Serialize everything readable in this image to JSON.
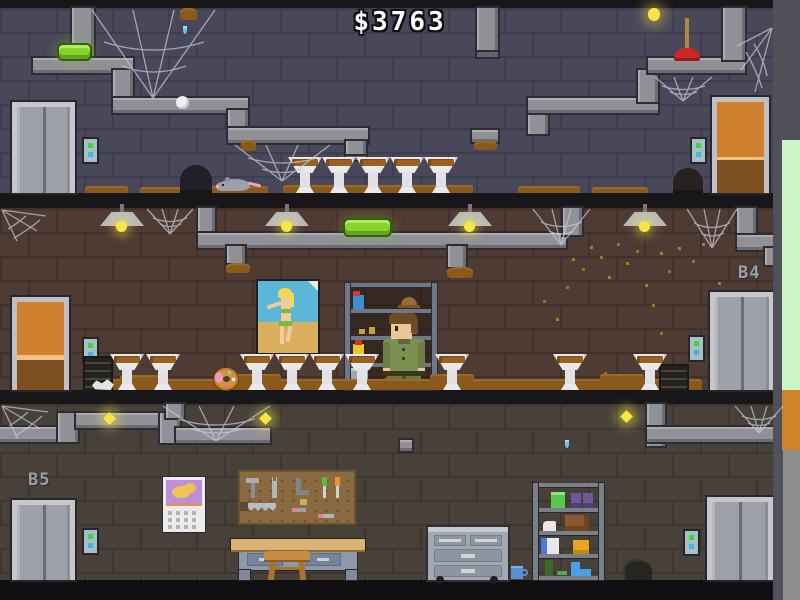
{
  "hud": {
    "money": "$3763"
  },
  "floors": {
    "b3": {
      "label": "",
      "objects": [
        "elevator-door",
        "call-button",
        "wooden-door",
        "dirty-sink x5",
        "rat",
        "mouse-hole",
        "wall-hole",
        "plunger",
        "ceiling-bulb",
        "green-tube-lamp",
        "white-egg",
        "pipes",
        "cobwebs",
        "dirt-patches"
      ]
    },
    "b4": {
      "label": "B4",
      "objects": [
        "wooden-door",
        "elevator-door",
        "call-button x2",
        "hanging-lamp x4",
        "green-tube-lamp",
        "pinup-poster",
        "supply-shelf",
        "spray-bottle",
        "hat",
        "yellow-bottle",
        "detergent-box",
        "bucket",
        "player-character",
        "dirty-sink x9",
        "donut",
        "floor-vent x2",
        "paper-scrap",
        "falling-dust",
        "pipes",
        "cobwebs",
        "dirt-floor"
      ]
    },
    "b5": {
      "label": "B5",
      "objects": [
        "elevator-door x2",
        "call-button x2",
        "firefly-light x3",
        "calendar",
        "pegboard-tools",
        "workbench",
        "stool",
        "drawer-cabinet",
        "mug",
        "storage-shelf",
        "trash-bag",
        "water-drip",
        "pipes",
        "cobwebs"
      ]
    }
  },
  "palette": {
    "wall-1": "#48485a",
    "wall-1-line": "#3d3d4e",
    "wall-2": "#4e3b33",
    "wall-2-line": "#42312a",
    "wall-3": "#47413a",
    "wall-3-line": "#3c362f",
    "band": "#17171a",
    "pipe": "#909096",
    "dirt": "#8a5a1d",
    "lamp-green": "#86d32a",
    "bulb-yellow": "#f6e544",
    "door-orange": "#d0812f",
    "elevator-gray": "#9da0a6",
    "plunger-red": "#cc2626",
    "strip-green": "#cdf5c8",
    "strip-orange": "#d0842a",
    "money-text": "#ffffff"
  }
}
